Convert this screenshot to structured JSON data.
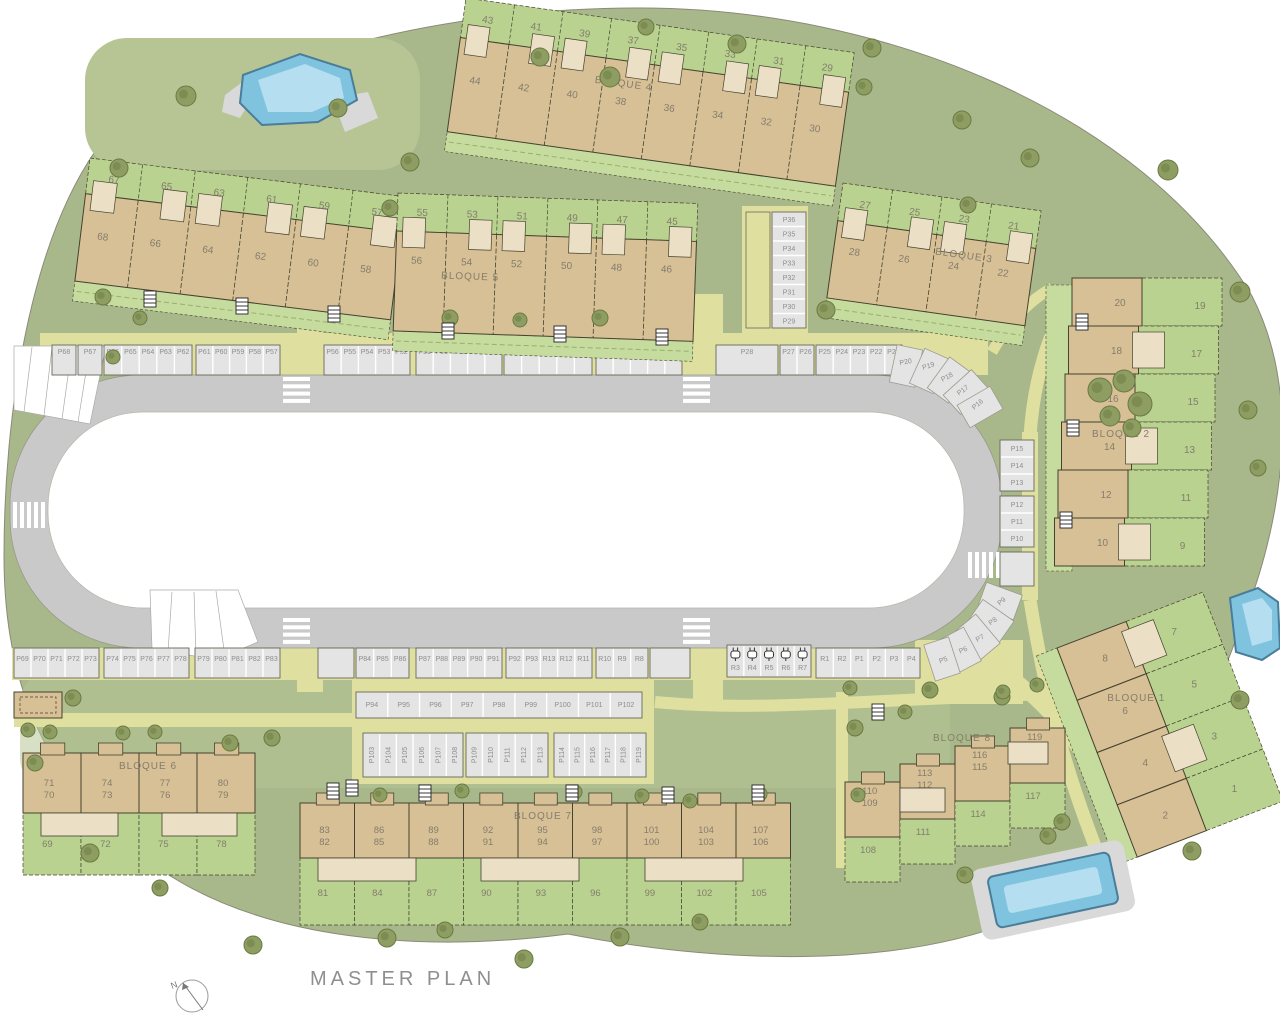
{
  "title": "MASTER PLAN",
  "compass": {
    "label": "N"
  },
  "colors": {
    "page_bg": "#ffffff",
    "site_green": "#a9b88a",
    "site_green_light": "#b7c595",
    "garden_green": "#b9d290",
    "garden_green_alt": "#c6db9e",
    "building_tan": "#d7bf96",
    "building_tan_light": "#ebdfc6",
    "road_grey": "#c9c9c9",
    "parking_grey": "#e4e4e4",
    "path_yellow": "#dfe0a0",
    "pool_blue": "#7fc3df",
    "pool_blue_light": "#b5dff0",
    "pool_outline": "#4a7d99",
    "deck_grey": "#d9d9d9",
    "tree_green": "#8e9e62",
    "tree_outline": "#6a7a42",
    "label_text": "#847e6c",
    "parking_text": "#8d8d8d",
    "outline_dark": "#44432f",
    "group_stroke": "#68685a",
    "white": "#ffffff"
  },
  "blocks": [
    {
      "id": "row57",
      "label": "",
      "gardens": [
        "67",
        "65",
        "63",
        "61",
        "59",
        "57"
      ],
      "buildings": [
        "68",
        "66",
        "64",
        "62",
        "60",
        "58"
      ]
    },
    {
      "id": "bloque5",
      "label": "BLOQUE 5",
      "gardens": [
        "55",
        "53",
        "51",
        "49",
        "47",
        "45"
      ],
      "buildings": [
        "56",
        "54",
        "52",
        "50",
        "48",
        "46"
      ]
    },
    {
      "id": "bloque4",
      "label": "BLOQUE 4",
      "gardens": [
        "43",
        "41",
        "39",
        "37",
        "35",
        "33",
        "31",
        "29"
      ],
      "buildings": [
        "44",
        "42",
        "40",
        "38",
        "36",
        "34",
        "32",
        "30"
      ]
    },
    {
      "id": "bloque3",
      "label": "BLOQUE 3",
      "gardens": [
        "27",
        "25",
        "23",
        "21"
      ],
      "buildings": [
        "28",
        "26",
        "24",
        "22"
      ]
    },
    {
      "id": "bloque2",
      "label": "BLOQUE 2",
      "gardens": [
        "19",
        "17",
        "15",
        "13",
        "11",
        "9"
      ],
      "buildings": [
        "20",
        "18",
        "16",
        "14",
        "12",
        "10"
      ]
    },
    {
      "id": "bloque1",
      "label": "BLOQUE 1",
      "gardens": [
        "7",
        "5",
        "3",
        "1"
      ],
      "buildings": [
        "8",
        "6",
        "4",
        "2"
      ]
    },
    {
      "id": "bloque6",
      "label": "BLOQUE 6",
      "units": [
        [
          "71",
          "70"
        ],
        [
          "74",
          "73"
        ],
        [
          "77",
          "76"
        ],
        [
          "80",
          "79"
        ]
      ],
      "gardens": [
        "69",
        "72",
        "75",
        "78"
      ]
    },
    {
      "id": "bloque7",
      "label": "BLOQUE 7",
      "units": [
        [
          "83",
          "82"
        ],
        [
          "86",
          "85"
        ],
        [
          "89",
          "88"
        ],
        [
          "92",
          "91"
        ],
        [
          "95",
          "94"
        ],
        [
          "98",
          "97"
        ],
        [
          "101",
          "100"
        ],
        [
          "104",
          "103"
        ],
        [
          "107",
          "106"
        ]
      ],
      "gardens": [
        "81",
        "84",
        "87",
        "90",
        "93",
        "96",
        "99",
        "102",
        "105"
      ]
    },
    {
      "id": "bloque8",
      "label": "BLOQUE 8",
      "units": [
        [
          "110",
          "109"
        ],
        [
          "113",
          "112"
        ],
        [
          "116",
          "115"
        ],
        [
          "119",
          "118"
        ]
      ],
      "gardens": [
        "108",
        "111",
        "114",
        "117"
      ]
    }
  ],
  "parking": {
    "top_row_groups": [
      [
        "P68"
      ],
      [
        "P67"
      ],
      [
        "P66",
        "P65",
        "P64",
        "P63",
        "P62"
      ],
      [
        "P61",
        "P60",
        "P59",
        "P58",
        "P57"
      ],
      [
        "P56",
        "P55",
        "P54",
        "P53",
        "P52"
      ],
      [
        "P51",
        "P50",
        "P49",
        "P48",
        "P47"
      ],
      [
        "P46",
        "P45",
        "P44",
        "P43",
        "P42"
      ],
      [
        "P41",
        "P40",
        "P39",
        "P38",
        "P37"
      ],
      [
        "P28"
      ],
      [
        "P27",
        "P26"
      ],
      [
        "P25",
        "P24",
        "P23",
        "P22",
        "P21"
      ]
    ],
    "top_curve": [
      "P20",
      "P19",
      "P18",
      "P17",
      "P16"
    ],
    "upper_stack": [
      "P36",
      "P35",
      "P34",
      "P33",
      "P32",
      "P31",
      "P30",
      "P29"
    ],
    "right_stack_a": [
      "P15",
      "P14",
      "P13"
    ],
    "right_stack_b": [
      "P12",
      "P11",
      "P10"
    ],
    "right_curve": [
      "P9",
      "P8",
      "P7",
      "P6",
      "P5"
    ],
    "bottom_row_groups": [
      [
        "P69",
        "P70",
        "P71",
        "P72",
        "P73"
      ],
      [
        "P74",
        "P75",
        "P76",
        "P77",
        "P78"
      ],
      [
        "P79",
        "P80",
        "P81",
        "P82",
        "P83"
      ],
      [
        "P84",
        "P85",
        "P86"
      ],
      [
        "P87",
        "P88",
        "P89",
        "P90",
        "P91"
      ],
      [
        "P92",
        "P93",
        "R13",
        "R12",
        "R11"
      ],
      [
        "R10",
        "R9",
        "R8"
      ]
    ],
    "ev_spaces": [
      "R3",
      "R4",
      "R5",
      "R6",
      "R7"
    ],
    "bottom_row_east": [
      "R1",
      "R2",
      "P1",
      "P2",
      "P3",
      "P4"
    ],
    "second_row": [
      "P94",
      "P95",
      "P96",
      "P97",
      "P98",
      "P99",
      "P100",
      "P101",
      "P102"
    ],
    "vertical_groups": [
      [
        "P103",
        "P104",
        "P105",
        "P106",
        "P107",
        "P108"
      ],
      [
        "P109",
        "P110",
        "P111",
        "P112",
        "P113"
      ],
      [
        "P114",
        "P115",
        "P116",
        "P117",
        "P118",
        "P119"
      ]
    ]
  }
}
